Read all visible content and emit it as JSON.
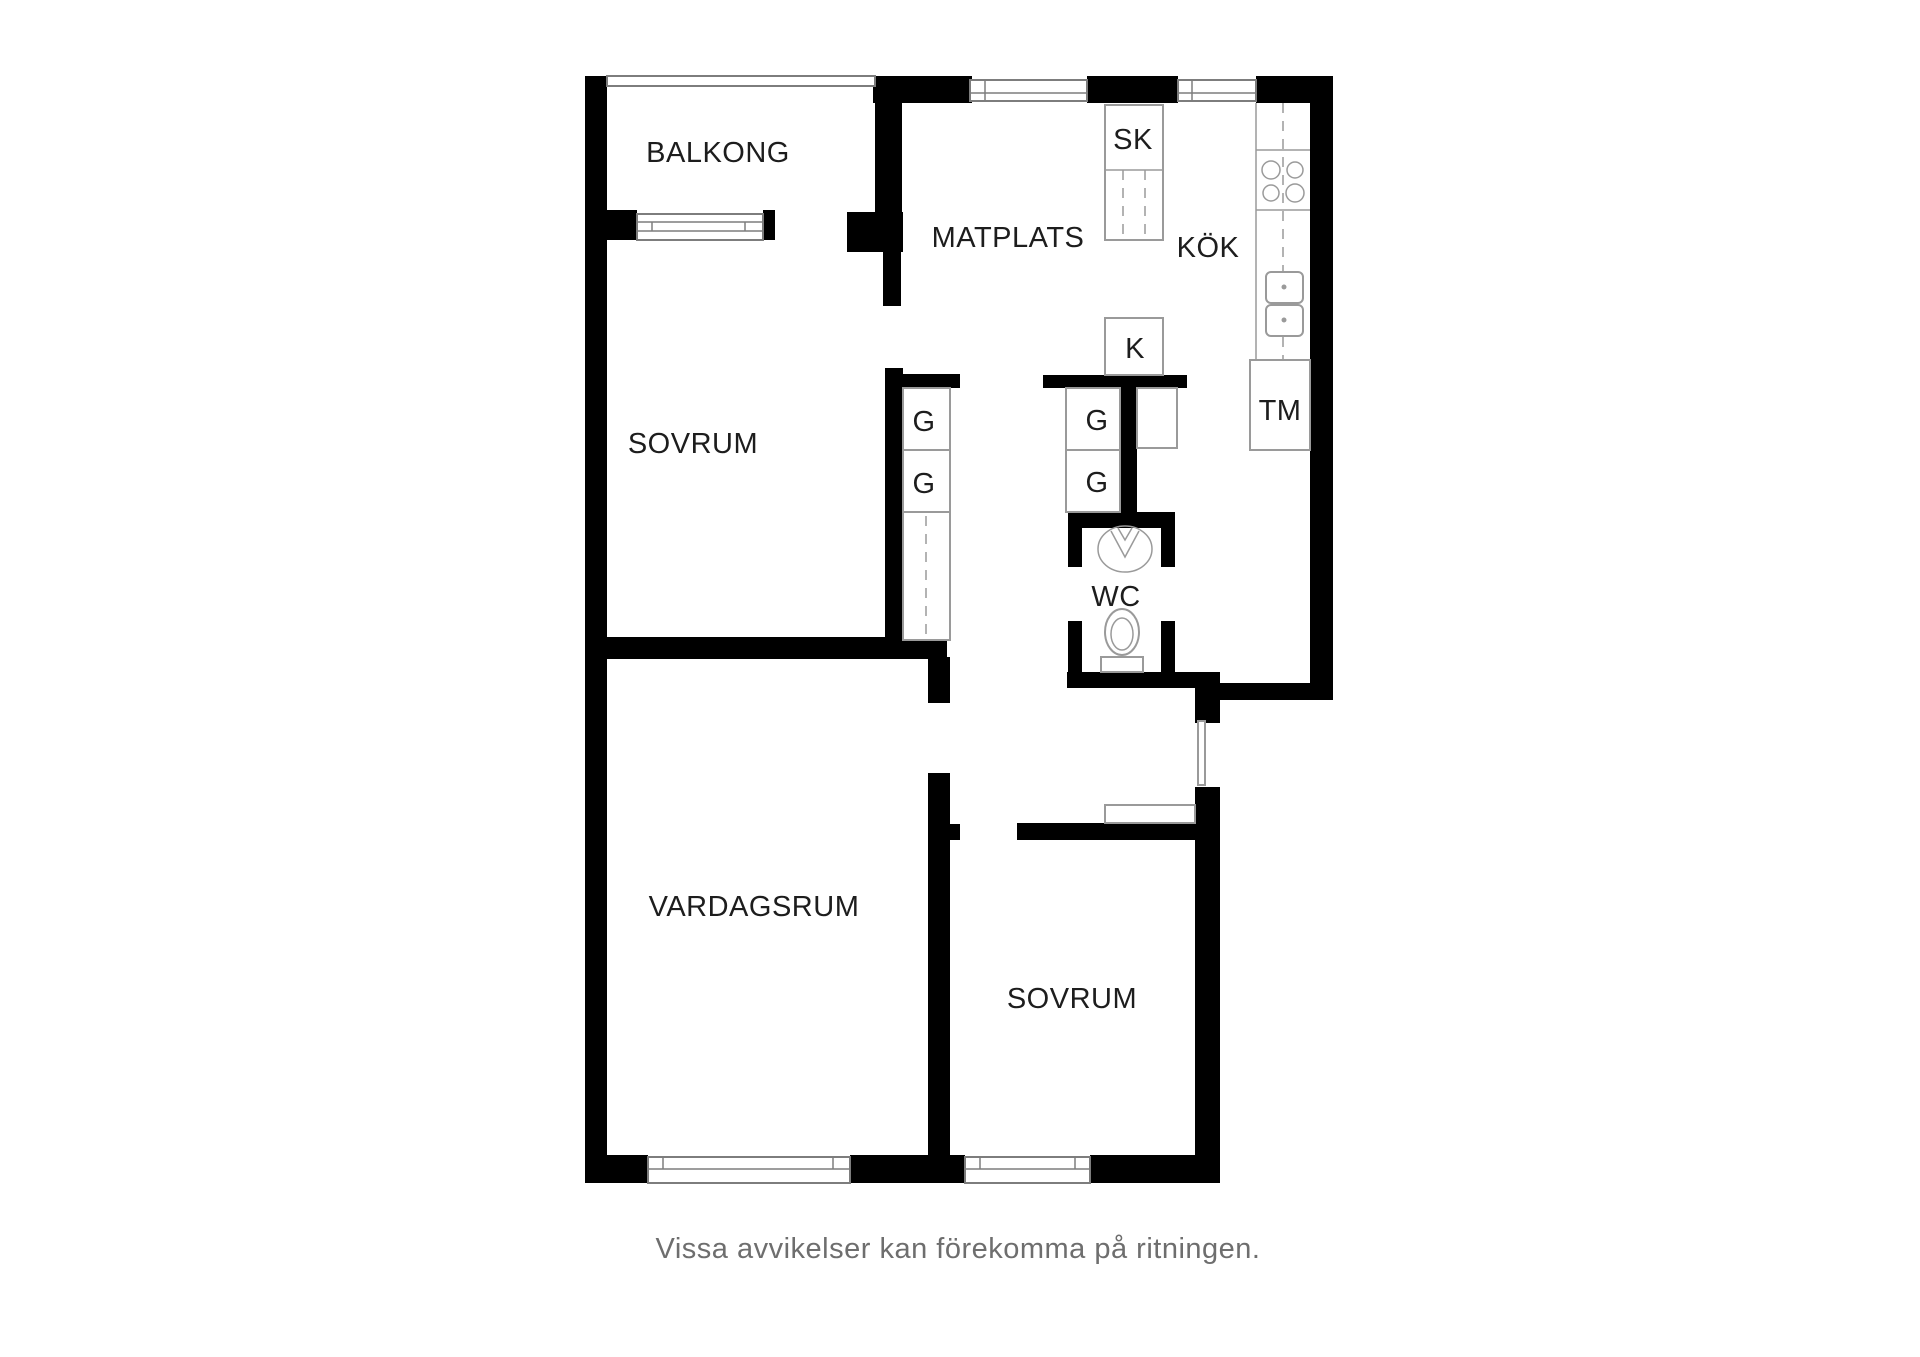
{
  "plan": {
    "rooms": {
      "balkong": {
        "label": "BALKONG"
      },
      "sovrum_top": {
        "label": "SOVRUM"
      },
      "matplats": {
        "label": "MATPLATS"
      },
      "kok": {
        "label": "KÖK"
      },
      "wc": {
        "label": "WC"
      },
      "vardagsrum": {
        "label": "VARDAGSRUM"
      },
      "sovrum_bottom": {
        "label": "SOVRUM"
      }
    },
    "fixtures": {
      "sk": {
        "label": "SK"
      },
      "k": {
        "label": "K"
      },
      "tm": {
        "label": "TM"
      },
      "g_sovrum_1": {
        "label": "G"
      },
      "g_sovrum_2": {
        "label": "G"
      },
      "g_hall_1": {
        "label": "G"
      },
      "g_hall_2": {
        "label": "G"
      }
    },
    "caption": "Vissa avvikelser kan förekomma på ritningen.",
    "colors": {
      "wall": "#000000",
      "outline": "#9a9a9a",
      "label": "#1d1d1d",
      "caption": "#6e6e6e",
      "background": "#ffffff"
    }
  }
}
